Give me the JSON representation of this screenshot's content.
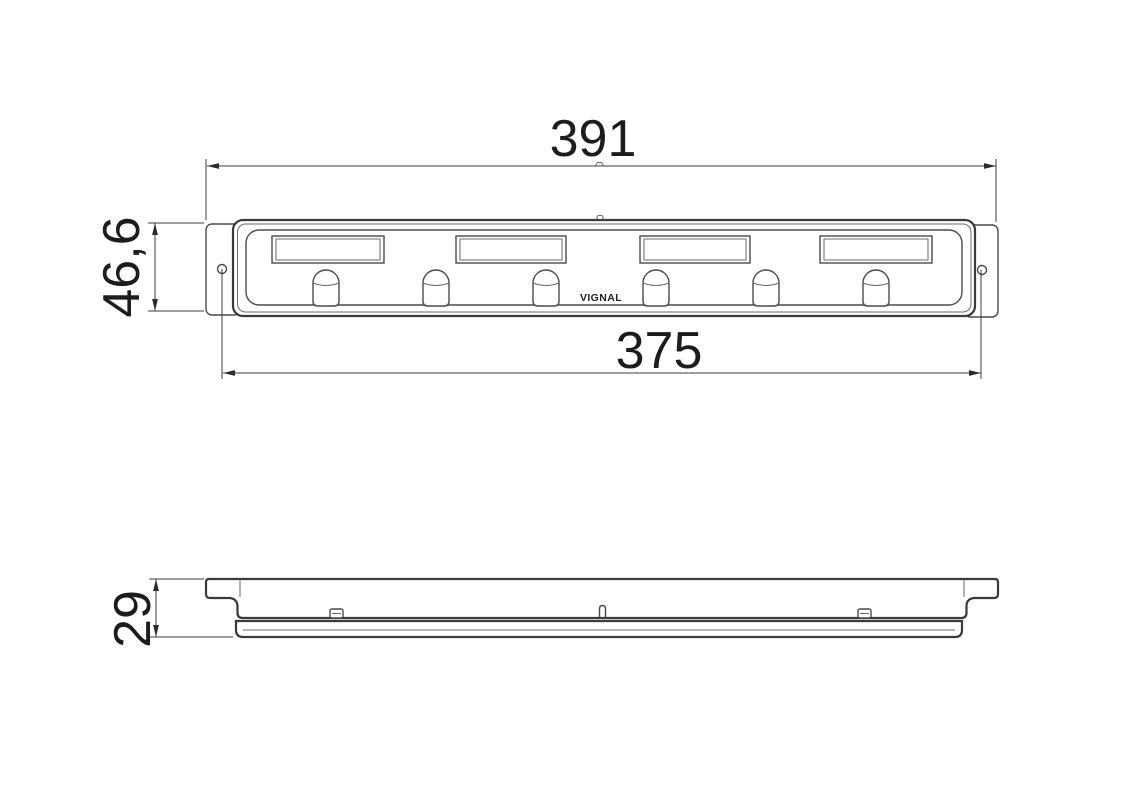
{
  "drawing": {
    "logo_text": "VIGNAL",
    "dimensions": {
      "overall_width": "391",
      "fixing_centres": "375",
      "height": "46,6",
      "depth": "29"
    }
  }
}
